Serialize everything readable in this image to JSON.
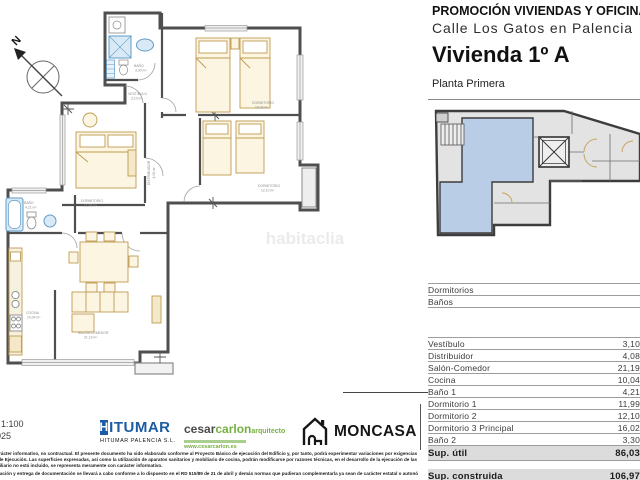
{
  "header": {
    "promo_line1": "PROMOCIÓN VIVIENDAS Y OFICINAS",
    "promo_line2": "Calle Los Gatos en Palencia",
    "unit_title": "Vivienda 1º A",
    "floor_label": "Planta Primera"
  },
  "plan": {
    "compass_label": "N",
    "watermark": "habitaclia",
    "rooms": [
      {
        "name": "BAÑO",
        "area": "3,30 m²"
      },
      {
        "name": "VESTIBULO",
        "area": "3,10 m²"
      },
      {
        "name": "DORMITORIO",
        "area": "16,02 m²"
      },
      {
        "name": "DORMITORIO",
        "area": "12,10 m²"
      },
      {
        "name": "DORMITORIO",
        "area": "11,99 m²"
      },
      {
        "name": "DISTRIBUIDOR",
        "area": "4,08 m²"
      },
      {
        "name": "BAÑO",
        "area": "4,21 m²"
      },
      {
        "name": "COCINA",
        "area": "10,04 m²"
      },
      {
        "name": "SALÓN-COMEDOR",
        "area": "21,19 m²"
      }
    ]
  },
  "table": {
    "head_rows": [
      {
        "label": "Dormitorios",
        "value": ""
      },
      {
        "label": "Baños",
        "value": ""
      }
    ],
    "rows": [
      {
        "label": "Vestíbulo",
        "value": "3,10"
      },
      {
        "label": "Distribuidor",
        "value": "4,08"
      },
      {
        "label": "Salón-Comedor",
        "value": "21,19"
      },
      {
        "label": "Cocina",
        "value": "10,04"
      },
      {
        "label": "Baño 1",
        "value": "4,21"
      },
      {
        "label": "Dormitorio 1",
        "value": "11,99"
      },
      {
        "label": "Dormitorio 2",
        "value": "12,10"
      },
      {
        "label": "Dormitorio 3 Principal",
        "value": "16,02"
      },
      {
        "label": "Baño 2",
        "value": "3,30"
      }
    ],
    "totals": [
      {
        "label": "Sup. útil",
        "value": "86,03"
      },
      {
        "label": "Sup. construida",
        "value": "106,97"
      }
    ]
  },
  "footer": {
    "scale_text": ": 1:100",
    "date_text": "025",
    "hitumar_h": "H",
    "hitumar_rest": "ITUMAR",
    "hitumar_sub": "HITUMAR PALENCIA S.L.",
    "architect_gray": "cesar",
    "architect_green": "carlon",
    "architect_title": "arquitecto",
    "architect_web": "www.cesarcarlon.es",
    "moncasa": "MONCASA",
    "disclaimer_lines": [
      "carácter informativo, no contractual. El presente documento ha sido elaborado conforme al Proyecto Básico de ejecución del Edificio y, por tanto, podrá experimentar variaciones por exigencias técnicas.",
      "o de Ejecución. Las superficies expresadas, así como la utilización de aparatos sanitarios y mobiliario de cocina, podrán modificarse por razones técnicas, en el desarrollo de la ejecución de las obras, el",
      "obiliario no está incluido, se representa meramente con carácter informativo.",
      "rmación y entrega de documentación se llevará a cabo conforme a lo dispuesto en el RD 515/89 de 21 de abril y demás normas que pudieran complementarla ya sean de carácter estatal o autonómico."
    ]
  },
  "colors": {
    "wall_gray": "#4f4f4f",
    "furniture_tan": "#bf9b4f",
    "fixture_blue_fill": "#d9eaf6",
    "fixture_blue_stroke": "#5f9cc9",
    "keyplan_highlight": "#b9cde6",
    "keyplan_room_gray": "#e3e3e3",
    "hitumar_blue": "#1d5ca4",
    "architect_green": "#76b043"
  }
}
